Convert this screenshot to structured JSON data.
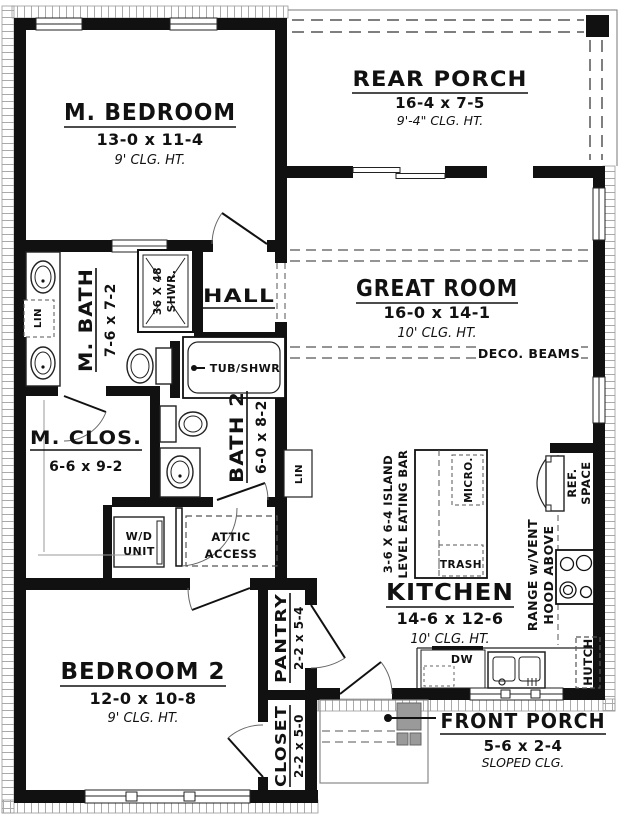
{
  "plan": {
    "rooms": {
      "m_bedroom": {
        "name": "M. BEDROOM",
        "dims": "13-0 x 11-4",
        "ceiling": "9' CLG. HT."
      },
      "rear_porch": {
        "name": "REAR PORCH",
        "dims": "16-4 x 7-5",
        "ceiling": "9'-4\" CLG. HT."
      },
      "great_room": {
        "name": "GREAT ROOM",
        "dims": "16-0 x 14-1",
        "ceiling": "10' CLG. HT.",
        "note": "DECO. BEAMS"
      },
      "hall": {
        "name": "HALL"
      },
      "m_bath": {
        "name": "M. BATH",
        "dims": "7-6 x 7-2"
      },
      "m_closet": {
        "name": "M. CLOS.",
        "dims": "6-6 x 9-2"
      },
      "bath2": {
        "name": "BATH 2",
        "dims": "6-0 x 8-2"
      },
      "kitchen": {
        "name": "KITCHEN",
        "dims": "14-6 x 12-6",
        "ceiling": "10' CLG. HT."
      },
      "bedroom2": {
        "name": "BEDROOM 2",
        "dims": "12-0 x 10-8",
        "ceiling": "9' CLG. HT."
      },
      "pantry": {
        "name": "PANTRY",
        "dims": "2-2 x 5-4"
      },
      "closet": {
        "name": "CLOSET",
        "dims": "2-2 x 5-0"
      },
      "front_porch": {
        "name": "FRONT PORCH",
        "dims": "5-6 x 2-4",
        "ceiling": "SLOPED CLG."
      }
    },
    "fixtures": {
      "shower_l1": "36 X 48",
      "shower_l2": "SHWR.",
      "tub": "TUB/SHWR",
      "lin_mbath": "LIN",
      "lin_hall": "LIN",
      "wd_l1": "W/D",
      "wd_l2": "UNIT",
      "attic_l1": "ATTIC",
      "attic_l2": "ACCESS",
      "island_l1": "3-6 X 6-4 ISLAND",
      "island_l2": "LEVEL EATING BAR",
      "micro": "MICRO.",
      "trash": "TRASH",
      "dw": "DW",
      "range_l1": "RANGE w/VENT",
      "range_l2": "HOOD ABOVE",
      "ref_l1": "REF.",
      "ref_l2": "SPACE",
      "hutch": "HUTCH"
    },
    "colors": {
      "wall": "#111111",
      "hatch": "#aaaaaa",
      "dash": "#555555",
      "porch_column": "#9a9a9a"
    }
  }
}
